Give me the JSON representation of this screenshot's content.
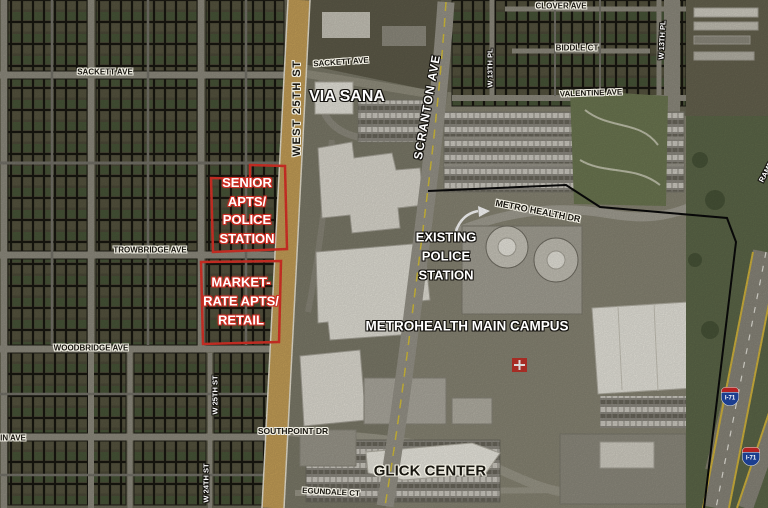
{
  "map": {
    "streets": {
      "sackett_ave_w": "SACKETT AVE",
      "sackett_ave_e": "SACKETT AVE",
      "west_25th_st": "WEST 25TH ST",
      "via_sana": "VIA SANA",
      "scranton_ave": "SCRANTON AVE",
      "w_13th_pl_w": "W 13TH PL",
      "w_13th_pl_e": "W 13TH PL",
      "clover_ave": "CLOVER AVE",
      "biddle_ct": "BIDDLE CT",
      "valentine_ave": "VALENTINE AVE",
      "metro_health_dr": "METRO HEALTH DR",
      "trowbridge_ave": "TROWBRIDGE AVE",
      "woodbridge_ave": "WOODBRIDGE AVE",
      "w_25th_st": "W 25TH ST",
      "in_ave": "IN AVE",
      "southpoint_dr": "SOUTHPOINT DR",
      "w_24th_st": "W 24TH ST",
      "egundale_ct": "EGUNDALE CT",
      "ramp": "RAMP"
    },
    "sites": {
      "senior": {
        "lines": [
          "SENIOR",
          "APTS/",
          "POLICE",
          "STATION"
        ]
      },
      "market": {
        "lines": [
          "MARKET-",
          "RATE APTS/",
          "RETAIL"
        ]
      },
      "existing_police": {
        "lines": [
          "EXISTING",
          "POLICE",
          "STATION"
        ]
      }
    },
    "places": {
      "metrohealth_campus": "METROHEALTH MAIN CAMPUS",
      "glick_center": "GLICK CENTER"
    },
    "shields": {
      "interstate": "I-71"
    },
    "colors": {
      "site_outline_red": "#e03328",
      "campus_boundary_black": "#0a0a0a",
      "road_tan": "#c6a058",
      "shield_blue": "#1c3e8f",
      "shield_red": "#b22222"
    }
  }
}
